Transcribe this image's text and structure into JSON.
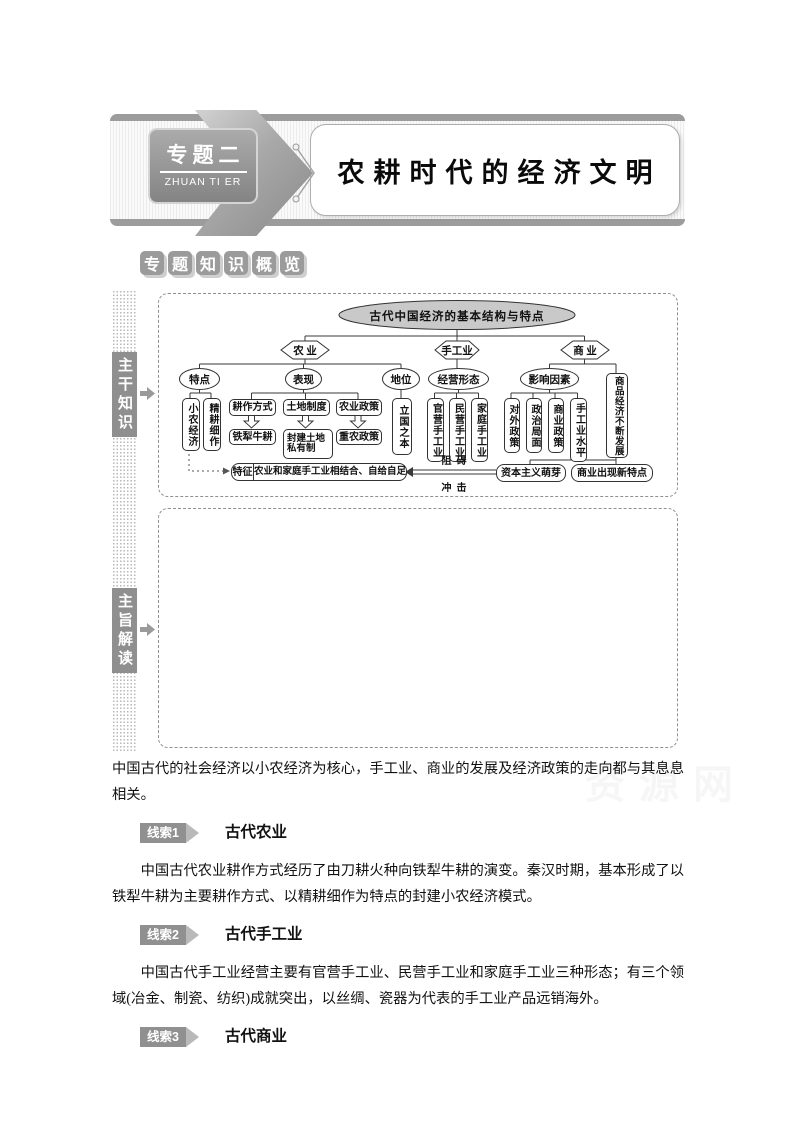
{
  "banner": {
    "badge_title": "专题二",
    "badge_subtitle": "ZHUAN TI ER",
    "title": "农耕时代的经济文明"
  },
  "section_label": {
    "chars": [
      "专",
      "题",
      "知",
      "识",
      "概",
      "览"
    ]
  },
  "sidebar": {
    "label1": "主干知识",
    "label2": "主旨解读"
  },
  "flowchart": {
    "root": "古代中国经济的基本结构与特点",
    "hex": {
      "agri": "农 业",
      "hand": "手工业",
      "comm": "商 业"
    },
    "l2": {
      "tedian": "特点",
      "biaoxian": "表现",
      "diwei": "地位",
      "jingying": "经营形态",
      "yingxiang": "影响因素"
    },
    "nodes": {
      "xiaonong": "小农经济",
      "jinggeng": "精耕细作",
      "gengzuo": "耕作方式",
      "tudi": "土地制度",
      "nongzheng": "农业政策",
      "tieli": "铁犁牛耕",
      "fengjian": "封建土地私有制",
      "zhongnong": "重农政策",
      "liguo": "立国之本",
      "guanying": "官营手工业",
      "minying": "民营手工业",
      "jiating": "家庭手工业",
      "duiwai": "对外政策",
      "zhengzhi": "政治局面",
      "shangzheng": "商业政策",
      "shuiping": "手工业水平",
      "shangpin": "商品经济不断发展",
      "tezheng_label": "特征",
      "tezheng_text": "农业和家庭手工业相结合、自给自足",
      "mengya": "资本主义萌芽",
      "xintedian": "商业出现新特点",
      "zuai": "阻  碍",
      "chongji": "冲  击"
    }
  },
  "content": {
    "intro": "中国古代的社会经济以小农经济为核心，手工业、商业的发展及经济政策的走向都与其息息相关。",
    "clues": [
      {
        "badge": "线索1",
        "title": "古代农业",
        "text": "中国古代农业耕作方式经历了由刀耕火种向铁犁牛耕的演变。秦汉时期，基本形成了以铁犁牛耕为主要耕作方式、以精耕细作为特点的封建小农经济模式。"
      },
      {
        "badge": "线索2",
        "title": "古代手工业",
        "text": "中国古代手工业经营主要有官营手工业、民营手工业和家庭手工业三种形态；有三个领域(冶金、制瓷、纺织)成就突出，以丝绸、瓷器为代表的手工业产品远销海外。"
      },
      {
        "badge": "线索3",
        "title": "古代商业",
        "text": ""
      }
    ]
  },
  "watermark": "资源网",
  "colors": {
    "accent_gray": "#8f8f8f",
    "line": "#3a3a3a",
    "ellipse_fill": "#c9c9c9"
  }
}
